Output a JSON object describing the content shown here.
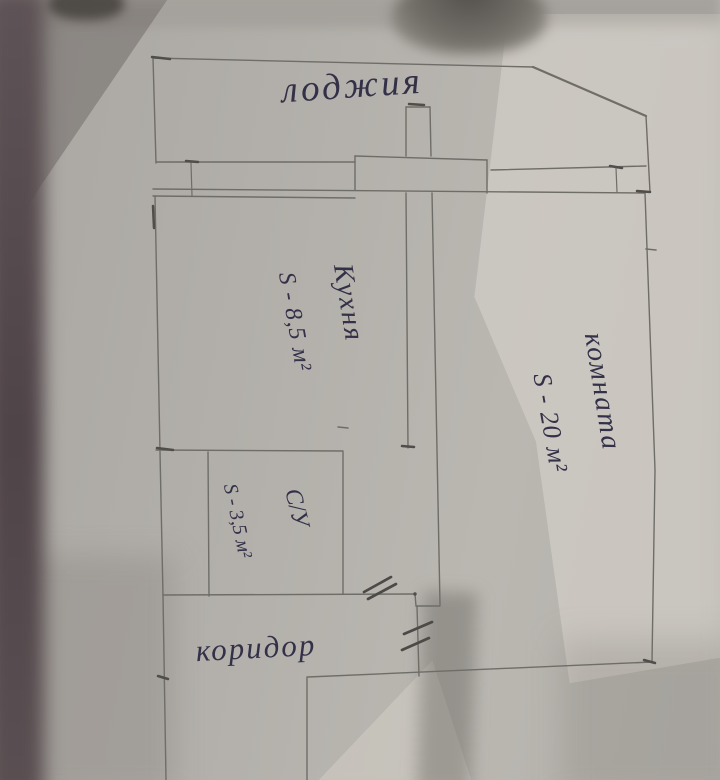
{
  "plan": {
    "labels": {
      "loggia": "лоджия",
      "kitchen_name": "Кухня",
      "kitchen_area": "S - 8,5 м²",
      "room_name": "комната",
      "room_area": "S - 20 м²",
      "bathroom_name": "С/У",
      "bathroom_area": "S - 3,5 м²",
      "corridor": "коридор"
    },
    "colors": {
      "ink": "#333048",
      "pencil": "#6f6d68",
      "pencil_bold": "#504e4a",
      "paper": "#b4b1ac"
    }
  }
}
